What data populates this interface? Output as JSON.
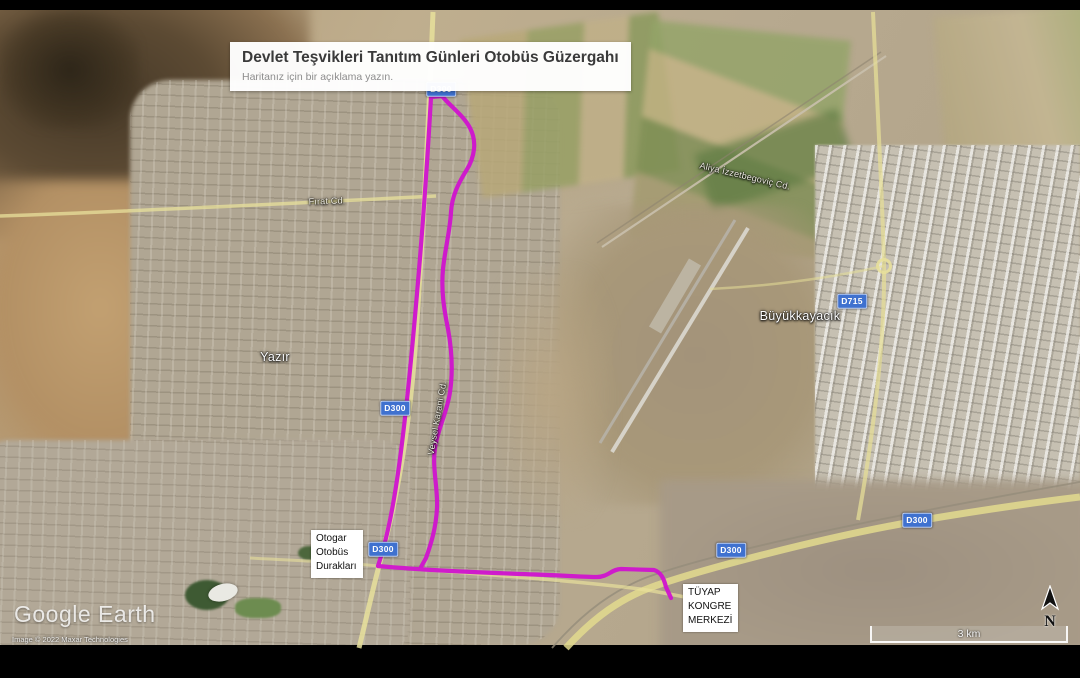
{
  "header": {
    "title": "Devlet Teşvikleri Tanıtım Günleri Otobüs Güzergahı",
    "subtitle": "Haritanız için bir açıklama yazın."
  },
  "placemarks": {
    "otogar": "Otogar\nOtobüs\nDurakları",
    "tuyap": "TÜYAP\nKONGRE\nMERKEZİ"
  },
  "place_labels": {
    "yazir": "Yazır",
    "buyukkayacik": "Büyükkayacık"
  },
  "road_labels": {
    "firat": "Fırat Cd.",
    "aliya": "Aliya İzzetbegoviç Cd.",
    "veysel": "Veysel Karani Cd."
  },
  "shields": {
    "d300": "D300",
    "d715": "D715"
  },
  "route": {
    "name": "Otobüs Güzergahı",
    "color": "#d013cf"
  },
  "attribution": {
    "brand": "Google Earth",
    "copyright": "Image © 2022 Maxar Technologies"
  },
  "scale_bar": {
    "label": "3 km"
  },
  "compass": {
    "label": "N"
  }
}
